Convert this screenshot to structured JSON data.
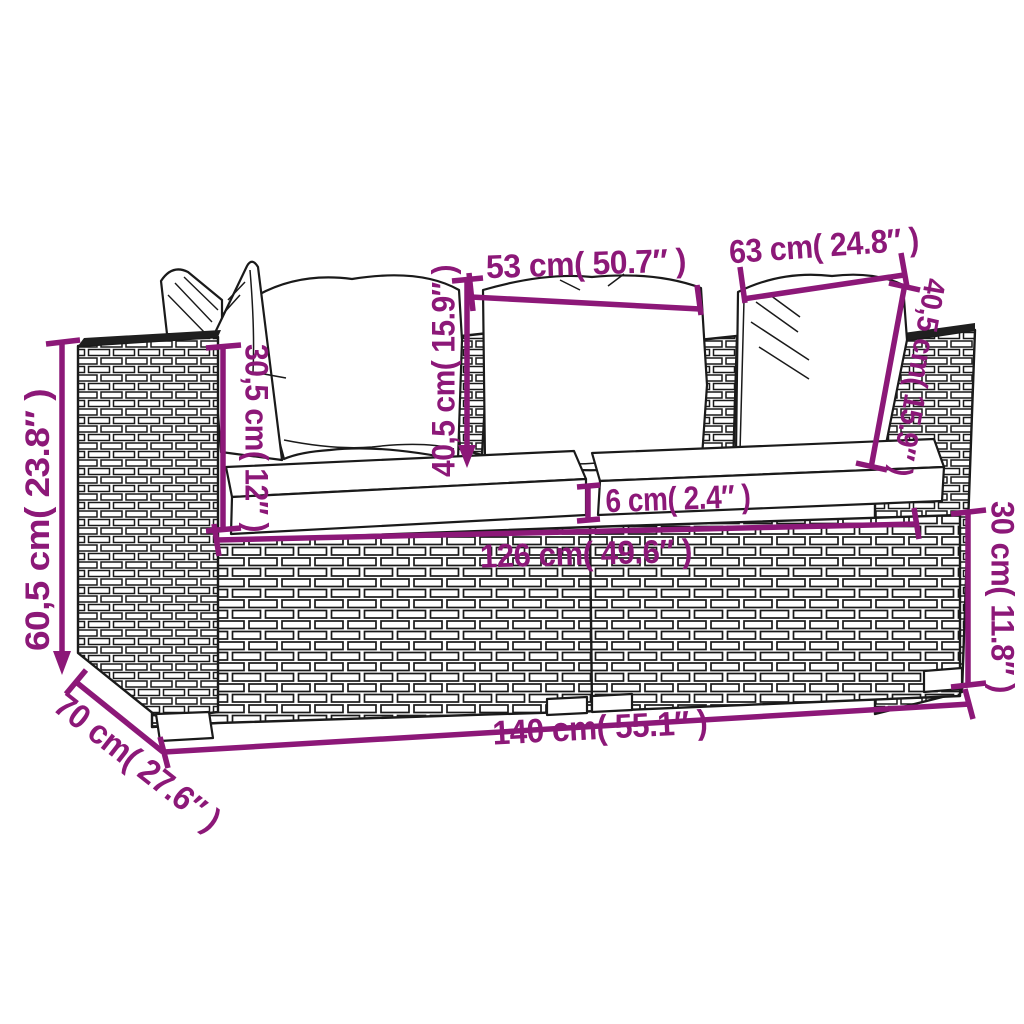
{
  "page": {
    "title": "Garden sofa set dimension diagram",
    "background": "#ffffff"
  },
  "diagram": {
    "subject": "2-seater poly rattan garden sofa with white cushions, line-art with dimension callouts",
    "style": {
      "annotation_color": "#8c1878",
      "line_color": "#1a1a1a"
    },
    "dimensions": {
      "seat_cushion_width_center": "53 cm( 50.7″ )",
      "seat_cushion_width_right": "63 cm( 24.8″ )",
      "back_cushion_height_center": "40,5 cm( 15.9″ )",
      "back_cushion_height_right": "40,5 cm( 15.9″ )",
      "armrest_height_above_seat": "30,5 cm( 12″ )",
      "total_height": "60,5 cm( 23.8″ )",
      "seat_cushion_thickness": "6 cm( 2.4″ )",
      "seat_width_inner": "126 cm( 49.6″ )",
      "frame_height": "30 cm( 11.8″ )",
      "total_width": "140 cm( 55.1″ )",
      "total_depth": "70 cm( 27.6″ )"
    }
  }
}
